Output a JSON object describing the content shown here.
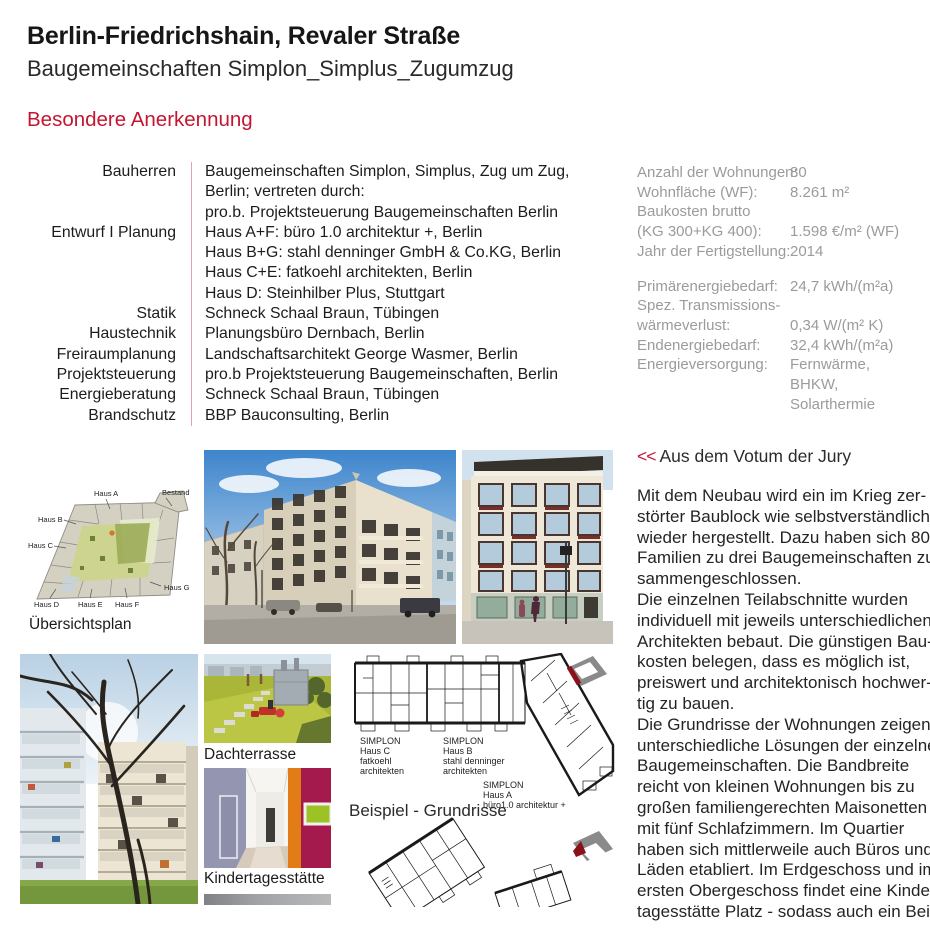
{
  "page": {
    "title": "Berlin-Friedrichshain, Revaler Straße",
    "subtitle": "Baugemeinschaften Simplon_Simplus_Zugumzug",
    "award": "Besondere Anerkennung"
  },
  "credits": {
    "rows": [
      {
        "label": "Bauherren",
        "lines": [
          "Baugemeinschaften Simplon, Simplus, Zug um Zug,",
          "Berlin; vertreten durch:",
          "pro.b. Projektsteuerung Baugemeinschaften Berlin"
        ]
      },
      {
        "label": "Entwurf I Planung",
        "lines": [
          "Haus A+F: büro 1.0 architektur +, Berlin",
          "Haus B+G: stahl denninger GmbH & Co.KG, Berlin",
          "Haus C+E: fatkoehl architekten, Berlin",
          "Haus D: Steinhilber Plus, Stuttgart"
        ]
      },
      {
        "label": "Statik",
        "lines": [
          "Schneck Schaal Braun, Tübingen"
        ]
      },
      {
        "label": "Haustechnik",
        "lines": [
          "Planungsbüro Dernbach, Berlin"
        ]
      },
      {
        "label": "Freiraumplanung",
        "lines": [
          "Landschaftsarchitekt George Wasmer, Berlin"
        ]
      },
      {
        "label": "Projektsteuerung",
        "lines": [
          "pro.b Projektsteuerung Baugemeinschaften, Berlin"
        ]
      },
      {
        "label": "Energieberatung",
        "lines": [
          "Schneck Schaal Braun, Tübingen"
        ]
      },
      {
        "label": "Brandschutz",
        "lines": [
          "BBP Bauconsulting, Berlin"
        ]
      }
    ]
  },
  "stats": {
    "rows": [
      {
        "label": "Anzahl der Wohnungen:",
        "value": "80"
      },
      {
        "label": "Wohnfläche (WF):",
        "value": "8.261 m²"
      },
      {
        "label": "Baukosten brutto",
        "value": ""
      },
      {
        "label": "(KG 300+KG 400):",
        "value": "1.598 €/m² (WF)"
      },
      {
        "label": "Jahr der Fertigstellung:",
        "value": "2014"
      },
      {
        "label": "Primärenergiebedarf:",
        "value": "24,7 kWh/(m²a)"
      },
      {
        "label": "Spez. Transmissions-",
        "value": ""
      },
      {
        "label": "wärmeverlust:",
        "value": "0,34 W/(m² K)"
      },
      {
        "label": "Endenergiebedarf:",
        "value": "32,4 kWh/(m²a)"
      },
      {
        "label": "Energieversorgung:",
        "value": "Fernwärme,"
      },
      {
        "label": "",
        "value": "BHKW,"
      },
      {
        "label": "",
        "value": "Solarthermie"
      }
    ]
  },
  "jury": {
    "marker": "<<",
    "heading": "Aus dem Votum der Jury",
    "lines": [
      "Mit dem Neubau wird ein im Krieg zer-",
      "störter Baublock wie selbstverständlich",
      "wieder hergestellt. Dazu haben sich 80",
      "Familien zu drei Baugemeinschaften zu-",
      "sammengeschlossen.",
      "Die einzelnen Teilabschnitte wurden",
      "individuell mit jeweils unterschiedlichen",
      "Architekten bebaut. Die günstigen Bau-",
      "kosten belegen, dass es möglich ist,",
      "preiswert und architektonisch hochwer-",
      "tig zu bauen.",
      "Die Grundrisse der Wohnungen zeigen",
      "unterschiedliche Lösungen der einzelnen",
      "Baugemeinschaften. Die Bandbreite",
      "reicht von kleinen Wohnungen bis zu",
      "großen familiengerechten Maisonetten",
      "mit fünf Schlafzimmern. Im Quartier",
      "haben sich mittlerweile auch Büros und",
      "Läden etabliert. Im Erdgeschoss und im",
      "ersten Obergeschoss findet eine Kinder-",
      "tagesstätte Platz - sodass auch ein Bei-"
    ]
  },
  "figures": {
    "site_plan": {
      "caption": "Übersichtsplan",
      "labels": [
        "Haus A",
        "Bestand",
        "Haus B",
        "Haus C",
        "Haus D",
        "Haus E",
        "Haus F",
        "Haus G"
      ]
    },
    "roof_terrace_caption": "Dachterrasse",
    "kita_caption": "Kindertagesstätte",
    "plans_caption": "Beispiel - Grundrisse",
    "plan_labels": [
      {
        "l0": "SIMPLON",
        "l1": "Haus C",
        "l2": "fatkoehl",
        "l3": "architekten"
      },
      {
        "l0": "SIMPLON",
        "l1": "Haus B",
        "l2": "stahl denninger",
        "l3": "architekten"
      },
      {
        "l0": "SIMPLON",
        "l1": "Haus A",
        "l2": "büro1.0 architektur +",
        "l3": ""
      }
    ]
  },
  "colors": {
    "accent_red": "#c31632",
    "divider_pink": "#e2a2b4",
    "stats_gray": "#9b9b9b",
    "keyplan_red": "#8a1218"
  }
}
